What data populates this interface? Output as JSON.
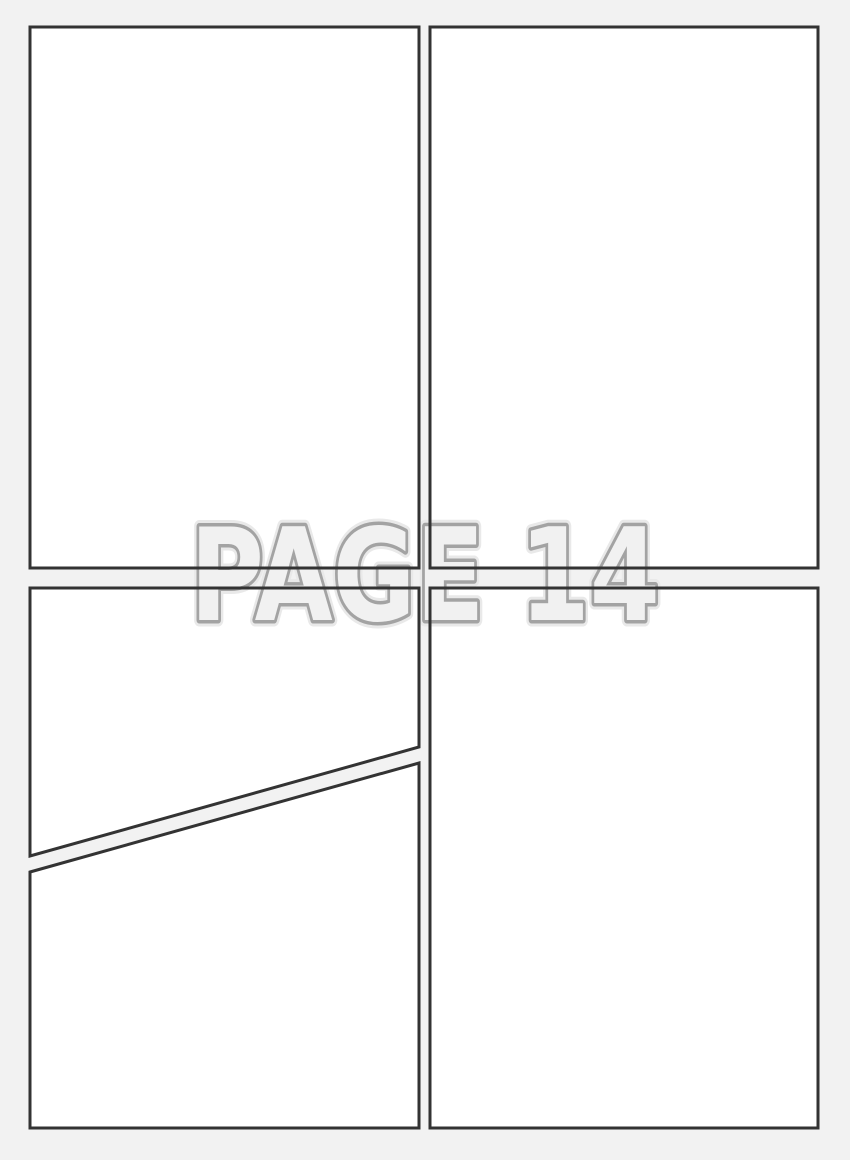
{
  "title": {
    "page_label": "PAGE 14"
  },
  "colors": {
    "background": "#f2f2f2",
    "panel_fill": "#ffffff",
    "panel_border": "#333333",
    "title_fill": "#f1f1f1",
    "title_stroke": "#a3a3a3",
    "title_halo": "#e9e9e9"
  }
}
